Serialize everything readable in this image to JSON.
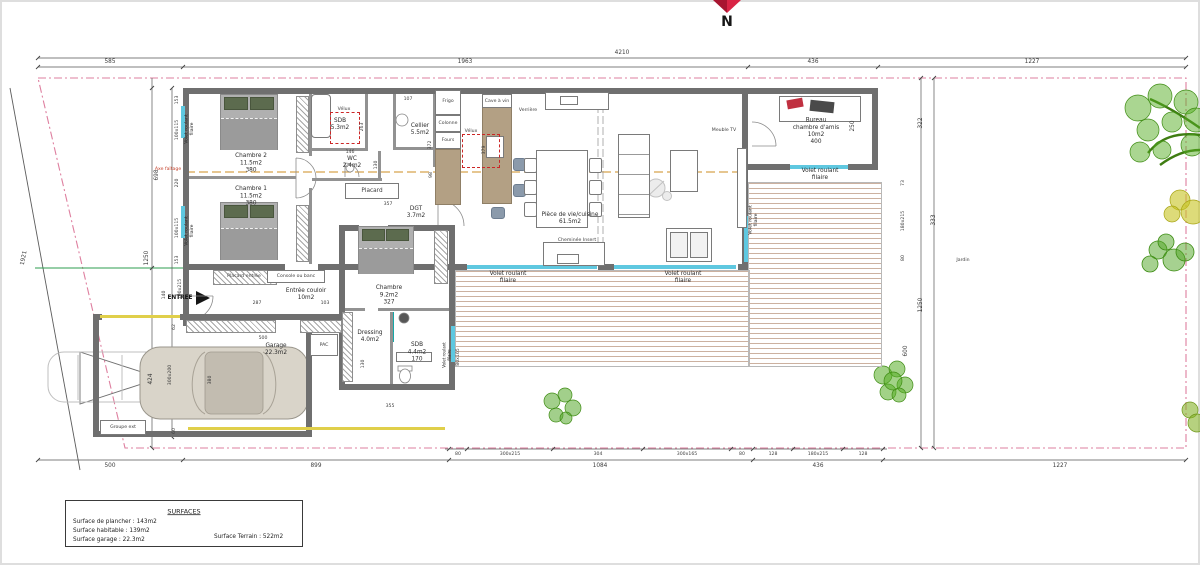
{
  "north": {
    "label": "N"
  },
  "colors": {
    "wall": "#6f6f6f",
    "window_blue": "#5fc8e0",
    "boundary_pink": "#de7f9f",
    "terrace_brown": "#ccb1a0",
    "door_yellow": "#e0cf4a",
    "tree_green": "#55ad24",
    "bush_yellow": "#c6c31f",
    "north_red": "#d92445",
    "ridge_axis_tan": "#ddb36c",
    "axis_text_red": "#c4402a",
    "green_utility_line": "#2e9e4f"
  },
  "rooms": {
    "chambre2": {
      "name": "Chambre 2",
      "area": "11.5m2",
      "dim": "380"
    },
    "chambre1": {
      "name": "Chambre 1",
      "area": "11.5m2",
      "dim": "380"
    },
    "sdb1": {
      "name": "SDB",
      "area": "5.3m2"
    },
    "wc": {
      "name": "WC",
      "area": "2.4m2"
    },
    "cellier": {
      "name": "Cellier",
      "area": "5.5m2"
    },
    "dgt": {
      "name": "DGT",
      "area": "3.7m2"
    },
    "piece_vie": {
      "name": "Pièce de vie/cuisine",
      "area": "61.5m2"
    },
    "bureau": {
      "name": "Bureau",
      "name2": "chambre d'amis",
      "area": "10m2",
      "dim": "400"
    },
    "entree_couloir": {
      "name": "Entrée couloir",
      "area": "10m2"
    },
    "chambre3": {
      "name": "Chambre",
      "area": "9.2m2",
      "dim": "327"
    },
    "dressing": {
      "name": "Dressing",
      "area": "4.0m2"
    },
    "sdb2": {
      "name": "SDB",
      "area": "4.4m2",
      "dim": "170"
    },
    "garage": {
      "name": "Garage",
      "area": "22.3m2"
    }
  },
  "fixtures": {
    "placard": "Placard",
    "placard_entree": "Placard entrée",
    "console": "Console ou banc",
    "frigo": "Frigo",
    "colonne": "Colonne",
    "fours": "Fours",
    "cave_vin": "Cave à vin",
    "verriere": "Verrière",
    "velux": "Vélux",
    "meuble_tv": "Meuble TV",
    "cheminee": "Cheminée Insert",
    "pac": "PAC",
    "groupe_ext": "Groupe ext",
    "entree": "ENTREE",
    "jardin": "Jardin",
    "axe": "Axe faîtage",
    "volet_line1": "Volet roulant",
    "volet_line2": "filaire"
  },
  "dims": {
    "top": [
      "4210",
      "585",
      "1963",
      "436",
      "1227"
    ],
    "bottom": [
      "80",
      "300x215",
      "304",
      "300x165",
      "80",
      "128",
      "180x215",
      "128",
      "500",
      "899",
      "1084",
      "436",
      "1227"
    ],
    "left": [
      "1921",
      "698",
      "1250",
      "424",
      "153",
      "100x115",
      "220",
      "100x115",
      "153",
      "140",
      "100x215",
      "62",
      "300x200",
      "60"
    ],
    "right": [
      "322",
      "73",
      "180x215",
      "333",
      "80",
      "1250",
      "600",
      "250"
    ],
    "inner": [
      "287",
      "103",
      "357",
      "107",
      "146",
      "372",
      "263",
      "379",
      "500",
      "380",
      "355",
      "130",
      "130",
      "98",
      "80x165"
    ]
  },
  "legend": {
    "title": "SURFACES",
    "line1": "Surface de plancher : 143m2",
    "line2": "Surface habitable : 139m2",
    "line3": "Surface garage : 22.3m2",
    "terrain": "Surface Terrain : 522m2"
  }
}
